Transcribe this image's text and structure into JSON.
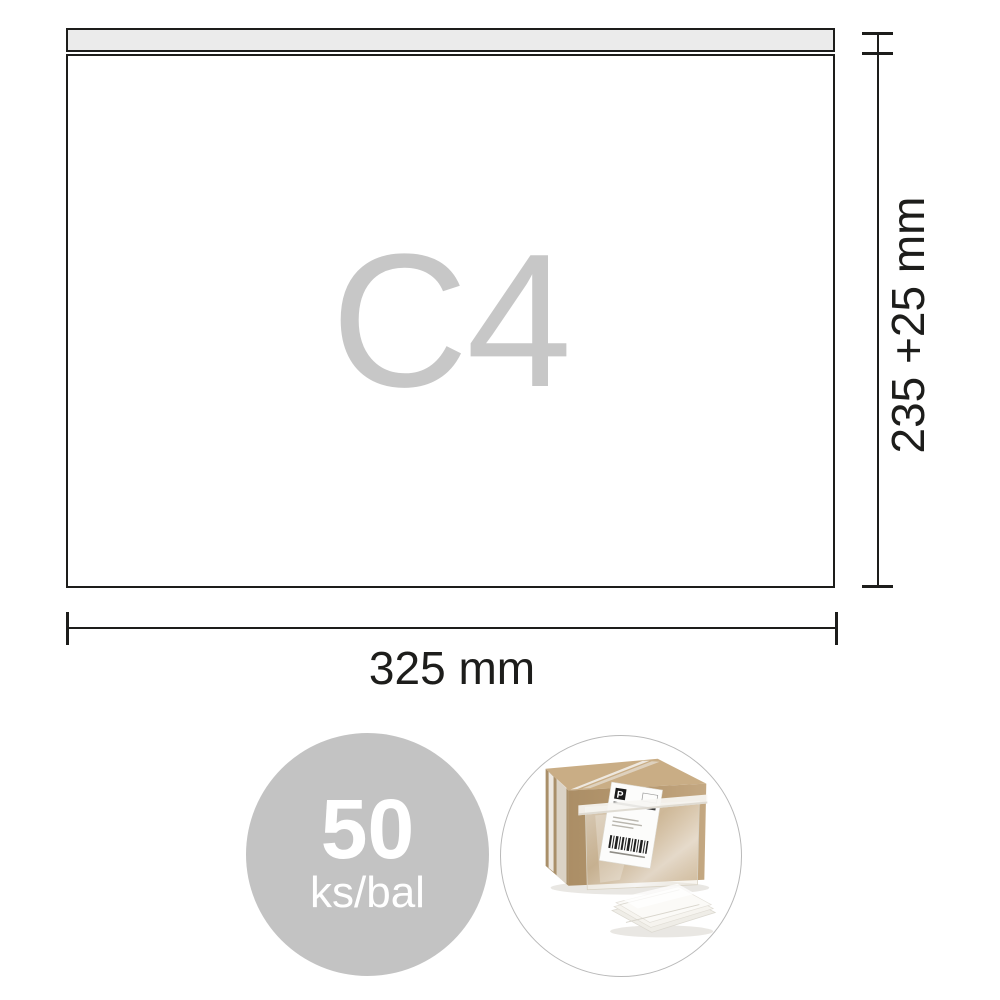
{
  "diagram": {
    "envelope": {
      "size_label": "C4",
      "size_label_color": "#c7c7c7",
      "flap_fill": "#ebebeb",
      "body_fill": "#ffffff",
      "border_color": "#1d1d1b"
    },
    "dimensions": {
      "height_label": "235 +25 mm",
      "width_label": "325 mm",
      "line_color": "#1d1d1b"
    }
  },
  "badge": {
    "quantity": "50",
    "unit": "ks/bal",
    "circle_color": "#c3c3c3",
    "text_color": "#ffffff"
  },
  "photo": {
    "label_letter": "P",
    "circle_border_color": "#b9b9b9",
    "box_front_color": "#b5976e",
    "box_top_color": "#c9ad85",
    "box_side_color": "#a98f69"
  }
}
